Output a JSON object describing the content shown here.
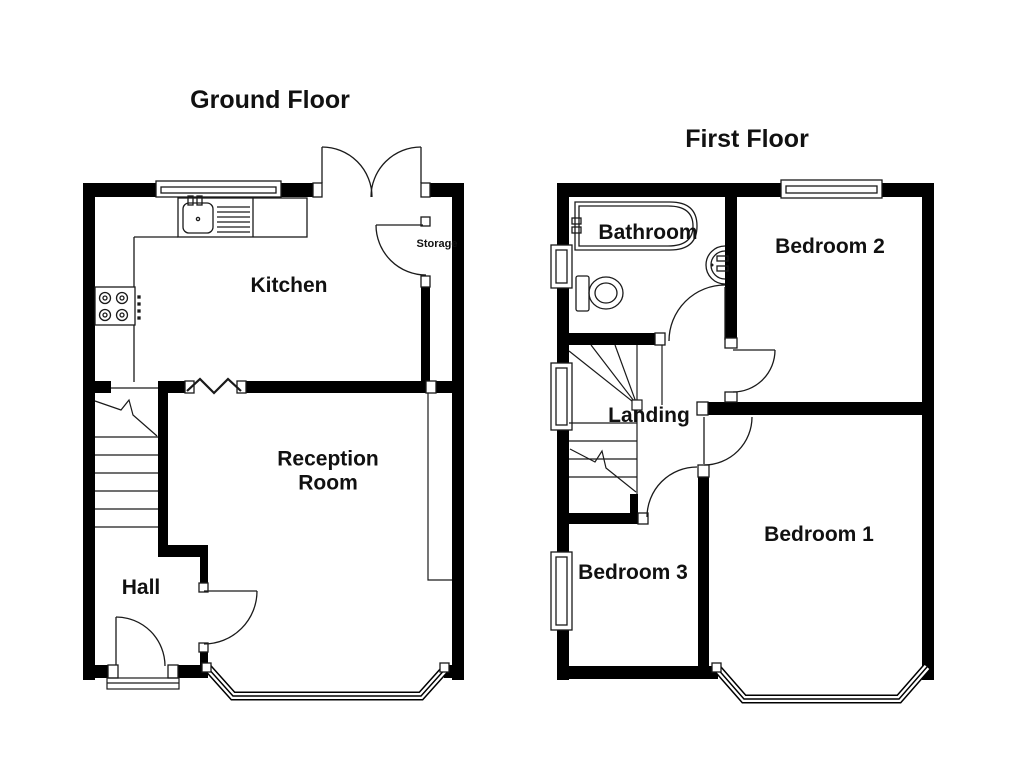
{
  "canvas": {
    "background": "#ffffff",
    "wall_color": "#000000",
    "line_color": "#1a1a1a"
  },
  "ground_floor": {
    "title": "Ground Floor",
    "labels": {
      "kitchen": "Kitchen",
      "reception_line1": "Reception",
      "reception_line2": "Room",
      "hall": "Hall",
      "storage": "Storage"
    },
    "fixtures": [
      "kitchen-sink-and-drainer",
      "hob-4-burners",
      "staircase",
      "french-doors",
      "front-door",
      "bay-window",
      "window",
      "chimney-breast"
    ]
  },
  "first_floor": {
    "title": "First Floor",
    "labels": {
      "bathroom": "Bathroom",
      "bedroom2": "Bedroom 2",
      "landing": "Landing",
      "bedroom3": "Bedroom 3",
      "bedroom1": "Bedroom 1"
    },
    "fixtures": [
      "bathtub",
      "toilet",
      "wash-basin",
      "winder-staircase",
      "bay-window",
      "windows"
    ]
  }
}
